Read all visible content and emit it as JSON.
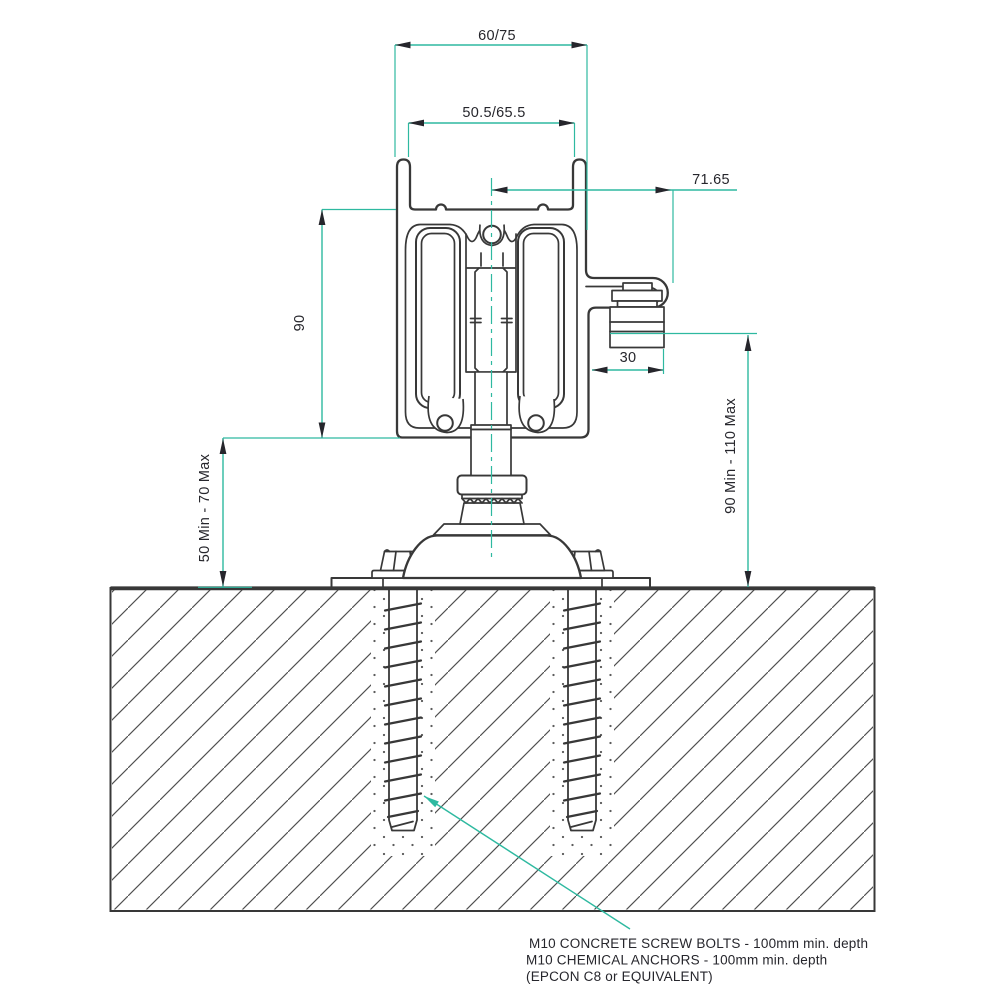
{
  "dimensions": {
    "outer_width": "60/75",
    "inner_width": "50.5/65.5",
    "bracket_offset": "71.65",
    "body_height": "90",
    "nut_width": "30",
    "floor_gap": "50 Min - 70 Max",
    "mount_range": "90 Min - 110 Max"
  },
  "callout": {
    "line1": "M10 CONCRETE SCREW BOLTS - 100mm min. depth",
    "line2": "M10 CHEMICAL ANCHORS - 100mm min. depth",
    "line3": "(EPCON C8 or EQUIVALENT)"
  },
  "colors": {
    "dimension_teal": "#2eb9a0",
    "drawing_line": "#383838",
    "text_dark": "#26262c"
  }
}
